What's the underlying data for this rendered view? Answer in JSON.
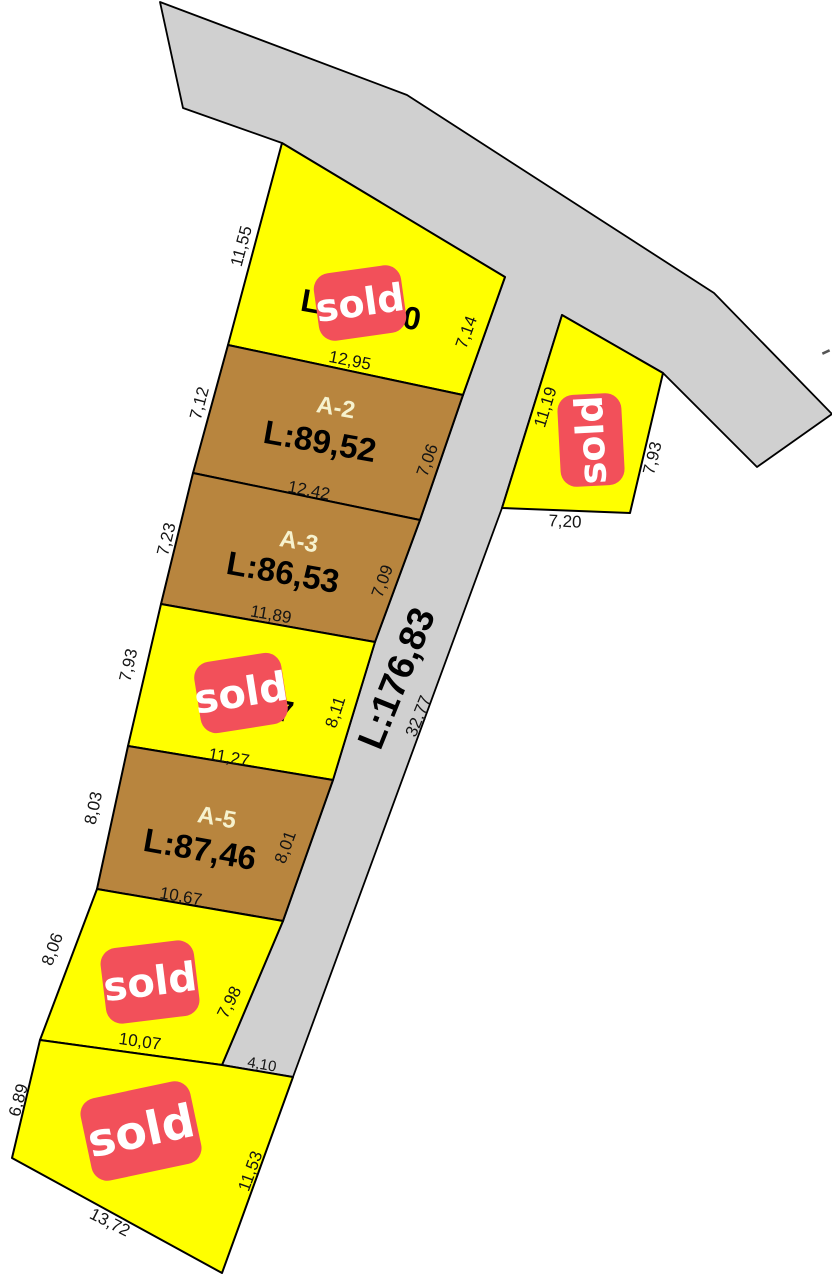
{
  "map": {
    "width": 832,
    "height": 1280,
    "colors": {
      "background": "#ffffff",
      "lot_yellow": "#ffff00",
      "lot_brown": "#b8853e",
      "road_gray": "#d0d0d0",
      "outline": "#000000",
      "sold_red": "#f2505a",
      "sold_text": "#ffffff",
      "lot_id_text": "#f6f2ce",
      "area_text": "#000000",
      "dim_text": "#141414"
    },
    "gray_region": {
      "name": "road-region",
      "points": [
        [
          160,
          2
        ],
        [
          407,
          95
        ],
        [
          714,
          293
        ],
        [
          832,
          414
        ],
        [
          757,
          467
        ],
        [
          663,
          373
        ],
        [
          562,
          315
        ],
        [
          502,
          508
        ],
        [
          293,
          1077
        ],
        [
          222,
          1065
        ],
        [
          283,
          921
        ],
        [
          333,
          780
        ],
        [
          375,
          642
        ],
        [
          420,
          520
        ],
        [
          463,
          395
        ],
        [
          505,
          277
        ],
        [
          282,
          143
        ],
        [
          183,
          108
        ]
      ]
    },
    "lots": [
      {
        "name": "lot-a1",
        "fill": "lot_yellow",
        "sold": true,
        "points": [
          [
            282,
            143
          ],
          [
            505,
            277
          ],
          [
            463,
            395
          ],
          [
            228,
            345
          ]
        ]
      },
      {
        "name": "lot-a2",
        "fill": "lot_brown",
        "sold": false,
        "points": [
          [
            228,
            345
          ],
          [
            463,
            395
          ],
          [
            420,
            520
          ],
          [
            193,
            473
          ]
        ]
      },
      {
        "name": "lot-a3",
        "fill": "lot_brown",
        "sold": false,
        "points": [
          [
            193,
            473
          ],
          [
            420,
            520
          ],
          [
            375,
            642
          ],
          [
            161,
            604
          ]
        ]
      },
      {
        "name": "lot-a4",
        "fill": "lot_yellow",
        "sold": true,
        "points": [
          [
            161,
            604
          ],
          [
            375,
            642
          ],
          [
            333,
            780
          ],
          [
            128,
            746
          ]
        ]
      },
      {
        "name": "lot-a5",
        "fill": "lot_brown",
        "sold": false,
        "points": [
          [
            128,
            746
          ],
          [
            333,
            780
          ],
          [
            283,
            921
          ],
          [
            97,
            889
          ]
        ]
      },
      {
        "name": "lot-a6",
        "fill": "lot_yellow",
        "sold": true,
        "points": [
          [
            97,
            889
          ],
          [
            283,
            921
          ],
          [
            222,
            1065
          ],
          [
            40,
            1040
          ]
        ]
      },
      {
        "name": "lot-a7",
        "fill": "lot_yellow",
        "sold": true,
        "points": [
          [
            40,
            1040
          ],
          [
            222,
            1065
          ],
          [
            293,
            1077
          ],
          [
            222,
            1273
          ],
          [
            12,
            1158
          ]
        ]
      },
      {
        "name": "lot-right",
        "fill": "lot_yellow",
        "sold": true,
        "points": [
          [
            562,
            315
          ],
          [
            663,
            373
          ],
          [
            630,
            513
          ],
          [
            502,
            508
          ]
        ]
      }
    ],
    "lot_labels": [
      {
        "name": "lot-a2-id",
        "text": "A-2",
        "x": 336,
        "y": 407,
        "rot": 10,
        "size": 24,
        "weight": "bold",
        "color": "lot_id_text"
      },
      {
        "name": "lot-a2-area",
        "text": "L:89,52",
        "x": 320,
        "y": 441,
        "rot": 10,
        "size": 33,
        "weight": "bold",
        "color": "area_text"
      },
      {
        "name": "lot-a3-id",
        "text": "A-3",
        "x": 299,
        "y": 541,
        "rot": 10,
        "size": 24,
        "weight": "bold",
        "color": "lot_id_text"
      },
      {
        "name": "lot-a3-area",
        "text": "L:86,53",
        "x": 283,
        "y": 572,
        "rot": 10,
        "size": 33,
        "weight": "bold",
        "color": "area_text"
      },
      {
        "name": "lot-a5-id",
        "text": "A-5",
        "x": 217,
        "y": 817,
        "rot": 10,
        "size": 24,
        "weight": "bold",
        "color": "lot_id_text"
      },
      {
        "name": "lot-a5-area",
        "text": "L:87,46",
        "x": 200,
        "y": 849,
        "rot": 10,
        "size": 33,
        "weight": "bold",
        "color": "area_text"
      }
    ],
    "label_fragments": [
      {
        "name": "lot-a1-area-fragment-left",
        "text": "L",
        "x": 311,
        "y": 301,
        "rot": 10,
        "size": 32,
        "weight": "bold",
        "color": "area_text"
      },
      {
        "name": "lot-a1-area-fragment-right",
        "text": "0",
        "x": 412,
        "y": 318,
        "rot": 10,
        "size": 32,
        "weight": "bold",
        "color": "area_text"
      },
      {
        "name": "lot-a4-area-fragment",
        "text": "7",
        "x": 285,
        "y": 711,
        "rot": 10,
        "size": 30,
        "weight": "bold",
        "color": "area_text"
      }
    ],
    "dimension_labels": [
      {
        "name": "dim-11-55",
        "text": "11,55",
        "x": 241,
        "y": 246,
        "rot": -75,
        "size": 17
      },
      {
        "name": "dim-7-12",
        "text": "7,12",
        "x": 199,
        "y": 403,
        "rot": -75,
        "size": 17
      },
      {
        "name": "dim-7-23",
        "text": "7,23",
        "x": 166,
        "y": 539,
        "rot": -76,
        "size": 17
      },
      {
        "name": "dim-7-93-left",
        "text": "7,93",
        "x": 128,
        "y": 665,
        "rot": -77,
        "size": 17
      },
      {
        "name": "dim-8-03",
        "text": "8,03",
        "x": 93,
        "y": 808,
        "rot": -78,
        "size": 17
      },
      {
        "name": "dim-8-06",
        "text": "8,06",
        "x": 52,
        "y": 949,
        "rot": -70,
        "size": 17
      },
      {
        "name": "dim-6-89",
        "text": "6,89",
        "x": 18,
        "y": 1100,
        "rot": -75,
        "size": 17
      },
      {
        "name": "dim-11-19",
        "text": "11,19",
        "x": 545,
        "y": 407,
        "rot": -73,
        "size": 17
      },
      {
        "name": "dim-7-14",
        "text": "7,14",
        "x": 466,
        "y": 332,
        "rot": -70,
        "size": 17
      },
      {
        "name": "dim-7-06",
        "text": "7,06",
        "x": 427,
        "y": 460,
        "rot": -70,
        "size": 17
      },
      {
        "name": "dim-7-09",
        "text": "7,09",
        "x": 382,
        "y": 581,
        "rot": -70,
        "size": 17
      },
      {
        "name": "dim-8-11",
        "text": "8,11",
        "x": 335,
        "y": 712,
        "rot": -72,
        "size": 17
      },
      {
        "name": "dim-8-01",
        "text": "8,01",
        "x": 285,
        "y": 847,
        "rot": -70,
        "size": 17
      },
      {
        "name": "dim-7-98",
        "text": "7,98",
        "x": 229,
        "y": 1002,
        "rot": -63,
        "size": 17
      },
      {
        "name": "dim-11-53",
        "text": "11,53",
        "x": 250,
        "y": 1171,
        "rot": -70,
        "size": 17
      },
      {
        "name": "dim-7-93-right",
        "text": "7,93",
        "x": 652,
        "y": 458,
        "rot": -76,
        "size": 17
      },
      {
        "name": "dim-12-95",
        "text": "12,95",
        "x": 350,
        "y": 360,
        "rot": 11,
        "size": 17
      },
      {
        "name": "dim-12-42",
        "text": "12,42",
        "x": 309,
        "y": 490,
        "rot": 11,
        "size": 17
      },
      {
        "name": "dim-11-89",
        "text": "11,89",
        "x": 271,
        "y": 614,
        "rot": 10,
        "size": 17
      },
      {
        "name": "dim-11-27",
        "text": "11,27",
        "x": 229,
        "y": 757,
        "rot": 10,
        "size": 17
      },
      {
        "name": "dim-10-67",
        "text": "10,67",
        "x": 181,
        "y": 896,
        "rot": 10,
        "size": 17
      },
      {
        "name": "dim-10-07",
        "text": "10,07",
        "x": 140,
        "y": 1041,
        "rot": 8,
        "size": 17
      },
      {
        "name": "dim-4-10",
        "text": "4,10",
        "x": 262,
        "y": 1064,
        "rot": 10,
        "size": 15
      },
      {
        "name": "dim-13-72",
        "text": "13,72",
        "x": 110,
        "y": 1222,
        "rot": 27,
        "size": 17
      },
      {
        "name": "dim-7-20",
        "text": "7,20",
        "x": 565,
        "y": 521,
        "rot": 3,
        "size": 17
      }
    ],
    "road_labels": [
      {
        "name": "road-length-label",
        "text": "L:176,83",
        "x": 396,
        "y": 678,
        "rot": -68,
        "size": 37,
        "weight": "bold",
        "color": "area_text"
      },
      {
        "name": "road-segment-label",
        "text": "32,77",
        "x": 418,
        "y": 716,
        "rot": -68,
        "size": 17,
        "weight": "normal",
        "color": "dim_text"
      }
    ],
    "sold_badges": [
      {
        "name": "sold-badge-a1",
        "label": "sold",
        "x": 360,
        "y": 303,
        "w": 88,
        "h": 68,
        "rot": -8,
        "size": 38
      },
      {
        "name": "sold-badge-right-lot",
        "label": "sold",
        "x": 591,
        "y": 440,
        "w": 92,
        "h": 64,
        "rot": -93,
        "size": 38
      },
      {
        "name": "sold-badge-a4",
        "label": "sold",
        "x": 241,
        "y": 693,
        "w": 88,
        "h": 72,
        "rot": -9,
        "size": 40
      },
      {
        "name": "sold-badge-a6",
        "label": "sold",
        "x": 150,
        "y": 982,
        "w": 94,
        "h": 76,
        "rot": -7,
        "size": 40
      },
      {
        "name": "sold-badge-a7",
        "label": "sold",
        "x": 141,
        "y": 1131,
        "w": 112,
        "h": 84,
        "rot": -12,
        "size": 46
      }
    ],
    "marks": [
      {
        "name": "stray-dot-mark",
        "type": "dot",
        "x": 192,
        "y": 1150,
        "r": 2.5
      },
      {
        "name": "stray-dash-mark",
        "type": "dash",
        "x": 826,
        "y": 352,
        "w": 8,
        "h": 2.5,
        "rot": -25
      }
    ]
  }
}
